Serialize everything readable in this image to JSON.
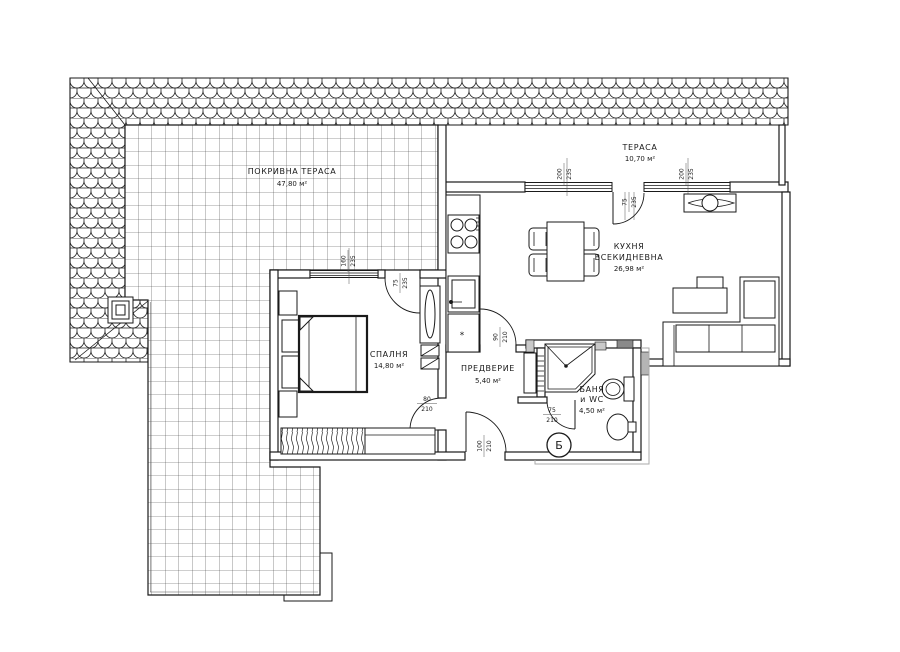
{
  "title": "Apartment floor plan",
  "rooms": {
    "roof_terrace": {
      "name": "ПОКРИВНА ТЕРАСА",
      "area": "47,80 м²"
    },
    "terrace": {
      "name": "ТЕРАСА",
      "area": "10,70 м²"
    },
    "kitchen_living": {
      "name_line1": "КУХНЯ",
      "name_line2": "ВСЕКИДНЕВНА",
      "area": "26,98 м²"
    },
    "bedroom": {
      "name": "СПАЛНЯ",
      "area": "14,80 м²"
    },
    "hallway": {
      "name": "ПРЕДВЕРИЕ",
      "area": "5,40 м²"
    },
    "bathroom": {
      "name_line1": "БАНЯ",
      "name_line2": "и WC",
      "area": "4,50 м²"
    }
  },
  "dimensions": {
    "terrace_window_left": {
      "w": "200",
      "h": "235"
    },
    "terrace_door": {
      "w": "75",
      "h": "235"
    },
    "terrace_window_right": {
      "w": "200",
      "h": "235"
    },
    "bedroom_window": {
      "w": "160",
      "h": "235"
    },
    "bedroom_terrace_door": {
      "w": "75",
      "h": "235"
    },
    "bedroom_hall_door": {
      "w": "80",
      "h": "210"
    },
    "hall_kitchen_door": {
      "w": "90",
      "h": "210"
    },
    "entrance_door": {
      "w": "100",
      "h": "210"
    },
    "bathroom_door": {
      "w": "75",
      "h": "210"
    }
  },
  "markers": {
    "section_letter": "Б",
    "boiler_symbol": "*"
  },
  "colors": {
    "line": "#1a1a1a",
    "pier_dark": "#8a8a8a",
    "pier_mid": "#b5b5b5",
    "pier_light": "#c9c9c9",
    "paper": "#ffffff"
  }
}
